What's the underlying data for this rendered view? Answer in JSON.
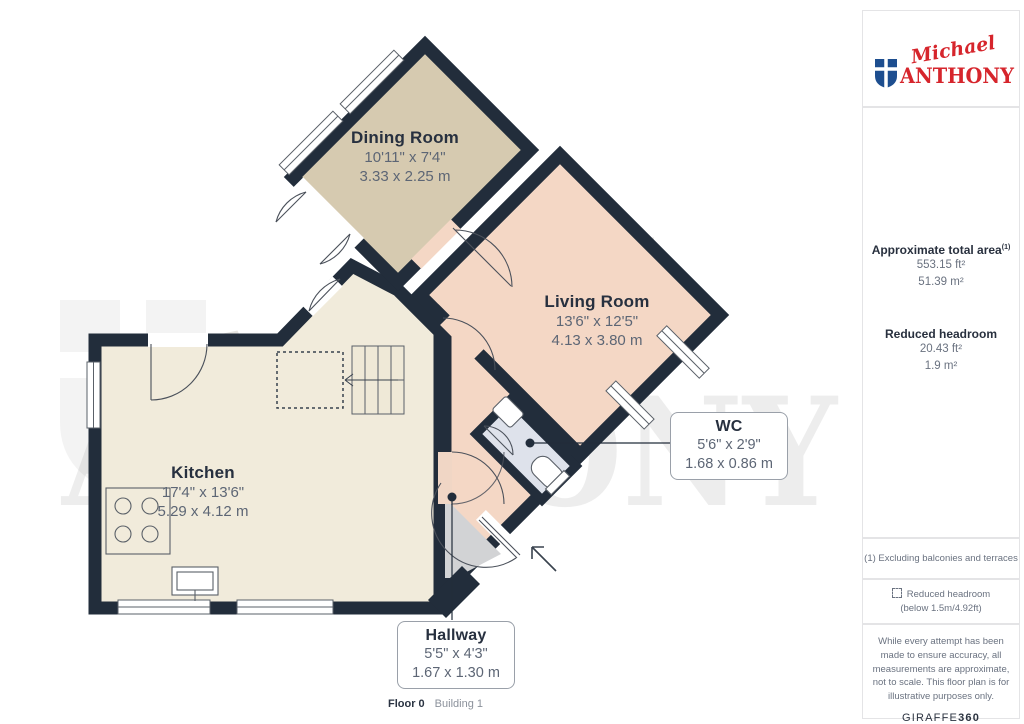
{
  "branding": {
    "logo_script": "Michael",
    "logo_main": "ANTHONY",
    "logo_red": "#d6252c",
    "shield_blue": "#1d4e8f"
  },
  "sidebar": {
    "total_area": {
      "title": "Approximate total area",
      "sup": "(1)",
      "ft": "553.15 ft²",
      "m": "51.39 m²"
    },
    "reduced_headroom": {
      "title": "Reduced headroom",
      "ft": "20.43 ft²",
      "m": "1.9 m²"
    },
    "footnote": "(1) Excluding balconies and terraces",
    "legend": {
      "label": "Reduced headroom",
      "sublabel": "(below 1.5m/4.92ft)"
    },
    "disclaimer": "While every attempt has been made to ensure accuracy, all measurements are approximate, not to scale. This floor plan is for illustrative purposes only.",
    "brand_footer": {
      "word": "GIRAFFE",
      "num": "360"
    }
  },
  "floorplan": {
    "rooms": [
      {
        "name": "Dining Room",
        "imperial": "10'11\" x 7'4\"",
        "metric": "3.33 x 2.25 m"
      },
      {
        "name": "Living Room",
        "imperial": "13'6\" x 12'5\"",
        "metric": "4.13 x 3.80 m"
      },
      {
        "name": "Kitchen",
        "imperial": "17'4\" x 13'6\"",
        "metric": "5.29 x 4.12 m"
      },
      {
        "name": "WC",
        "imperial": "5'6\" x 2'9\"",
        "metric": "1.68 x 0.86 m"
      },
      {
        "name": "Hallway",
        "imperial": "5'5\" x 4'3\"",
        "metric": "1.67 x 1.30 m"
      }
    ],
    "footer": {
      "floor": "Floor 0",
      "building": "Building 1"
    },
    "colors": {
      "wall": "#222d3b",
      "kitchen": "#f1ebdb",
      "dining": "#d6cab0",
      "living": "#f4d7c5",
      "wc": "#dee2eb",
      "hallway": "#d2d3d5"
    }
  },
  "watermark": {
    "script": "Michael",
    "main": "ANTHONY"
  }
}
